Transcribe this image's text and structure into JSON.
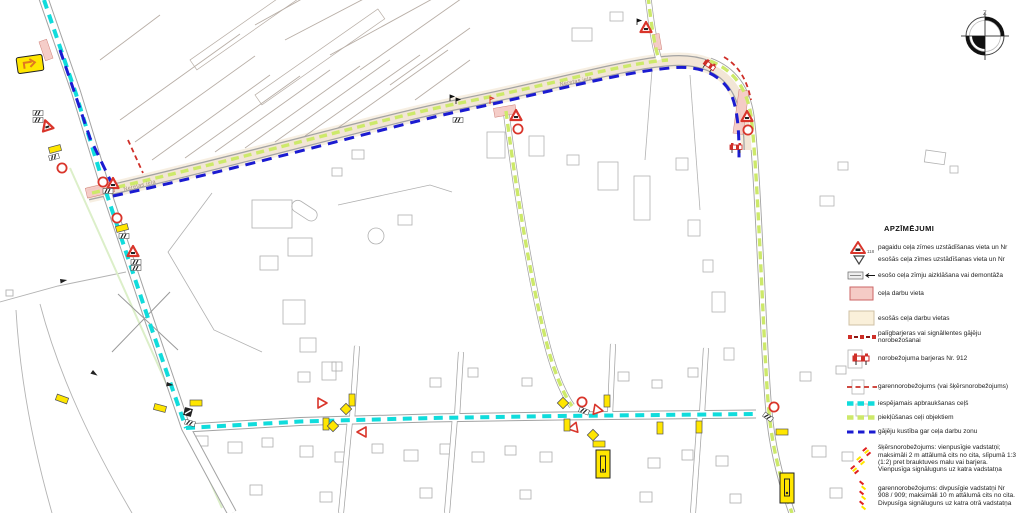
{
  "legend": {
    "title": "APZĪMĒJUMI",
    "items": [
      {
        "text": "pagaidu ceļa zīmes uzstādīšanas vieta un Nr",
        "number": "118"
      },
      {
        "text": "esošās ceļa zīmes uzstādīšanas vieta un Nr"
      },
      {
        "text": "esošo ceļa zīmju aizklāšana vai demontāža"
      },
      {
        "text": "ceļa darbu vieta"
      },
      {
        "text": "esošās ceļa darbu vietas"
      },
      {
        "text": "palīgbarjeras vai signāllentes gājēju norobežošanai"
      },
      {
        "text": "norobežojuma barjeras Nr. 912"
      },
      {
        "text": "garennorobežojums (vai šķērsnorobežojums)"
      },
      {
        "text": "iespējamais apbraukšanas ceļš"
      },
      {
        "text": "piekļūšanas ceļi objektiem"
      },
      {
        "text": "gājēju kustība gar ceļa darbu zonu"
      },
      {
        "text": "šķērsnorobežojums: vienpusīgie vadstatņi; maksimāli 2 m attālumā cits no cita, slīpumā 1:3 (1:2) pret brauktuves malu vai barjera. Vienpusīga signāluguns uz katra vadstatņa"
      },
      {
        "text": "garennorobežojums: divpusīgie vadstatņi Nr 908 / 909; maksimāli 10 m attālumā cits no cita. Divpusīga signāluguns uz katra otrā vadstatņa"
      }
    ]
  },
  "map": {
    "street_labels": [
      "Neretas iela",
      "Neretas iela"
    ],
    "compass_label": "Z"
  },
  "colors": {
    "detour_route_cyan": "#10dcdc",
    "access_route_green": "#cde96a",
    "pedestrian_route_blue": "#1b1bd1",
    "barrier_red": "#cf2f28",
    "works_area_pink": "#f5cbc6",
    "existing_works_beige": "#f7ecd9",
    "sign_yellow": "#ffe600"
  }
}
